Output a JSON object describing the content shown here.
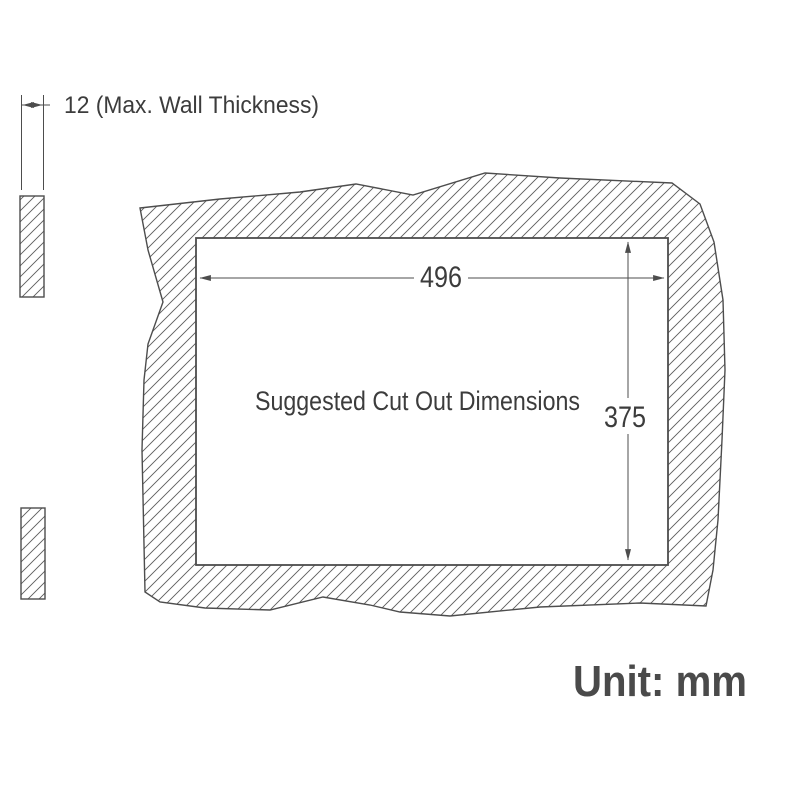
{
  "colors": {
    "background": "#ffffff",
    "line": "#4d4d4d",
    "hatch": "#5c5c5c",
    "text": "#3c3c3c",
    "unit_text": "#4a4a4a"
  },
  "annotations": {
    "wall_thickness_label": "12 (Max. Wall Thickness)",
    "cutout_width": "496",
    "cutout_height": "375",
    "cutout_label": "Suggested Cut Out Dimensions",
    "unit_label": "Unit: mm"
  }
}
